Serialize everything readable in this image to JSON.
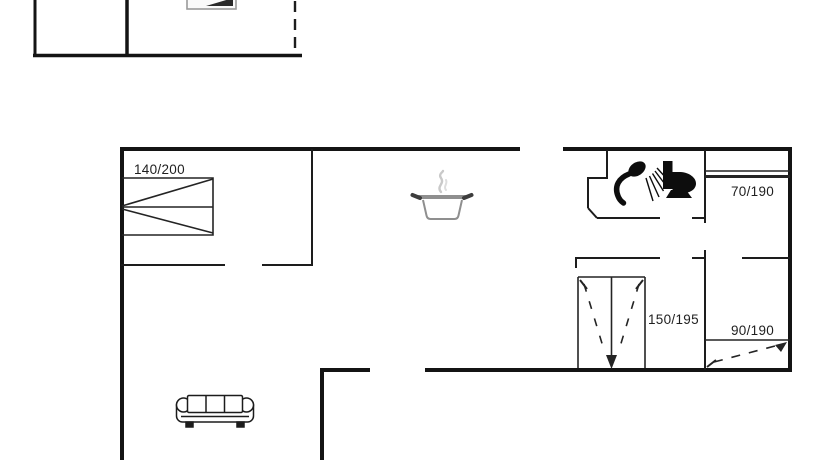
{
  "canvas": {
    "background": "#ffffff",
    "line_color": "#161616",
    "pot_gray": "#8f8f8f",
    "steam_gray": "#c9c9c9"
  },
  "floorplan": {
    "bed_labels": {
      "bed_main": "140/200",
      "bed_right_top": "70/190",
      "bed_middle": "150/195",
      "bed_right_bottom": "90/190"
    },
    "icons": [
      "cooking-pot-icon",
      "shower-icon",
      "toilet-icon",
      "sofa-icon",
      "bed-icon",
      "cropped-appliance-icon"
    ]
  }
}
